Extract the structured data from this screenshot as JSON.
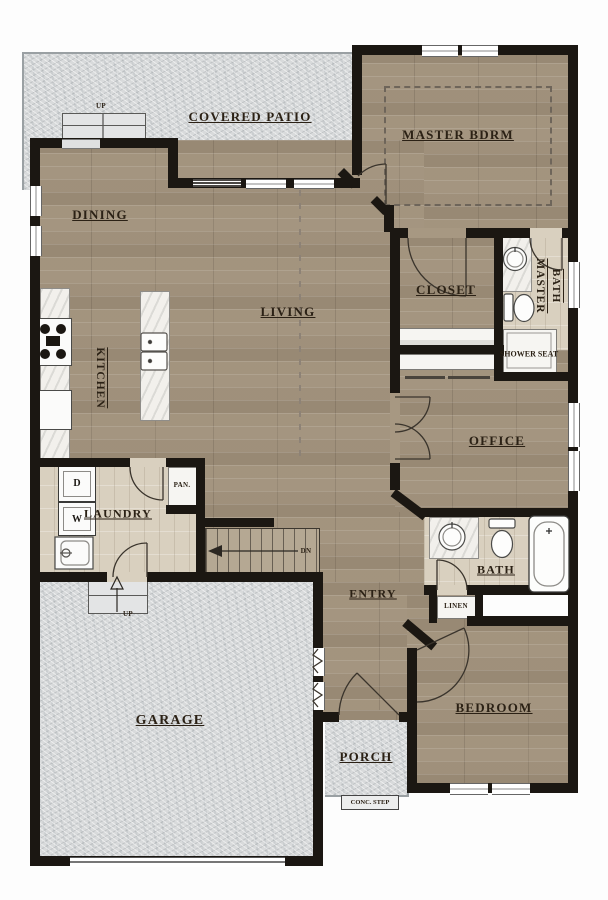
{
  "rooms": {
    "covered_patio": "COVERED PATIO",
    "master_bdrm": "MASTER BDRM",
    "dining": "DINING",
    "closet": "CLOSET",
    "master_word": "MASTER",
    "bath_word": "BATH",
    "living": "LIVING",
    "kitchen": "KITCHEN",
    "shower_seat": "SHOWER SEAT",
    "office": "OFFICE",
    "laundry": "LAUNDRY",
    "pantry": "PAN.",
    "bath": "BATH",
    "entry": "ENTRY",
    "linen": "LINEN",
    "garage": "GARAGE",
    "bedroom": "BEDROOM",
    "porch": "PORCH"
  },
  "labels": {
    "up": "UP",
    "dn": "DN",
    "conc_step": "CONC. STEP",
    "washer": "W",
    "dryer": "D"
  },
  "colors": {
    "wall": "#1b1712",
    "wood_floor": "#a79882",
    "tile_floor": "#d9d0bf",
    "concrete": "#d8dadb",
    "counter": "#f2f0ec",
    "text": "#2b2115"
  }
}
